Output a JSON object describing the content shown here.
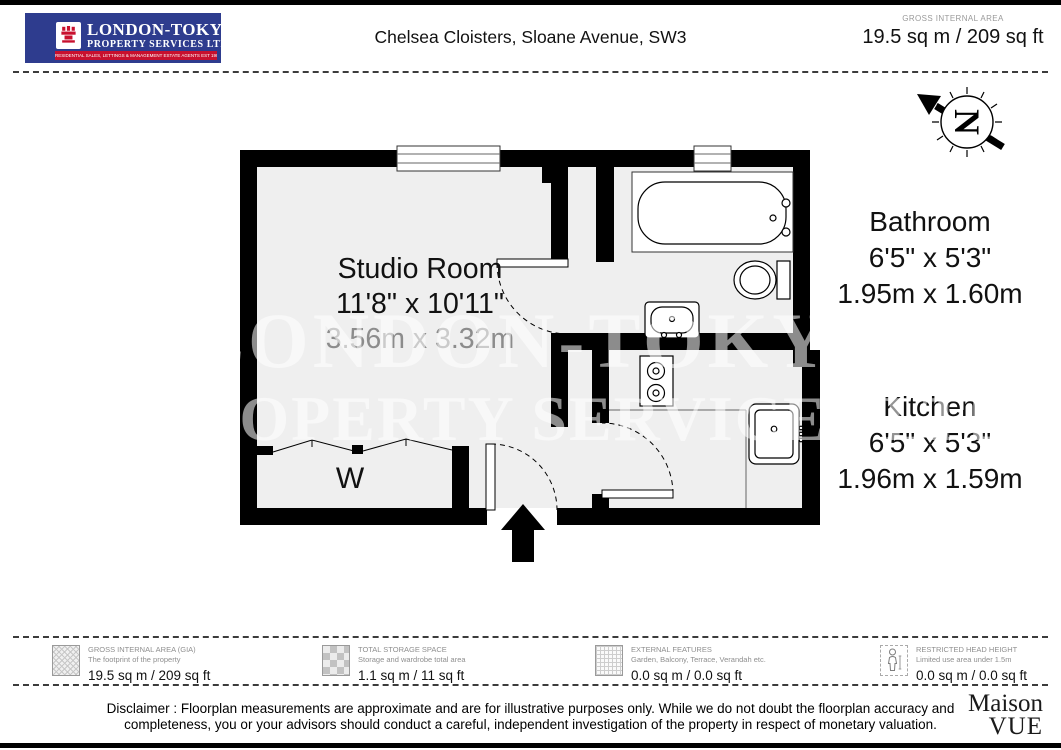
{
  "theme": {
    "logo-blue": "#2e3c8e",
    "logo-red": "#c8102e",
    "wall": "#000000",
    "floor": "#efefef"
  },
  "header": {
    "logo": {
      "line1": "LONDON-TOKYO",
      "line2": "PROPERTY SERVICES LTD.",
      "line3": "RESIDENTIAL SALES, LETTINGS & MANAGEMENT ESTATE AGENTS EST 1987"
    },
    "title": "Chelsea Cloisters, Sloane Avenue, SW3",
    "gia_label": "GROSS INTERNAL AREA",
    "gia_value": "19.5 sq m / 209 sq ft"
  },
  "compass": {
    "letter": "N"
  },
  "floorplan": {
    "watermark_line1": "LONDON-TOKYO",
    "watermark_line2": "PROPERTY SERVICES LTD",
    "wardrobe_label": "W",
    "rooms": [
      {
        "name": "Studio Room",
        "imperial": "11'8\" x 10'11\"",
        "metric": "3.56m x 3.32m"
      },
      {
        "name": "Bathroom",
        "imperial": "6'5\" x 5'3\"",
        "metric": "1.95m x 1.60m"
      },
      {
        "name": "Kitchen",
        "imperial": "6'5\" x 5'3\"",
        "metric": "1.96m x 1.59m"
      }
    ]
  },
  "legend": {
    "items": [
      {
        "title": "GROSS INTERNAL AREA (GIA)",
        "subtitle": "The footprint of the property",
        "value": "19.5 sq m / 209 sq ft"
      },
      {
        "title": "TOTAL STORAGE SPACE",
        "subtitle": "Storage and wardrobe total area",
        "value": "1.1 sq m / 11 sq ft"
      },
      {
        "title": "EXTERNAL FEATURES",
        "subtitle": "Garden, Balcony, Terrace, Verandah etc.",
        "value": "0.0 sq m / 0.0 sq ft"
      },
      {
        "title": "RESTRICTED HEAD HEIGHT",
        "subtitle": "Limited use area under 1.5m",
        "value": "0.0 sq m / 0.0 sq ft"
      }
    ]
  },
  "footer": {
    "disclaimer": "Disclaimer : Floorplan measurements are approximate and are for illustrative purposes only. While we do not doubt the floorplan accuracy and completeness, you or your advisors should conduct a careful, independent investigation of the property in respect of monetary valuation.",
    "brand_line1": "Maison",
    "brand_line2": "VUE"
  }
}
